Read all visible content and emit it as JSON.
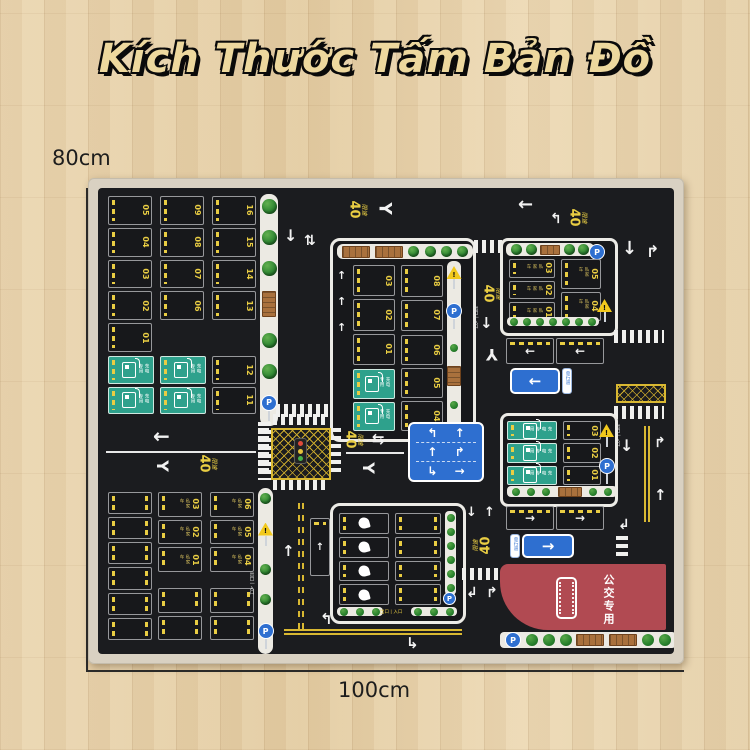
{
  "title": "Kích Thước Tấm Bản Đồ",
  "dimensions": {
    "height": "80cm",
    "width": "100cm"
  },
  "labels": {
    "speed_limit_prefix": "限速",
    "speed_limit_value": "40",
    "exit_entry": "出口 | 入口",
    "bus_only": "公交专用",
    "one_way": "单行道",
    "private_car": "私家车",
    "charging": "充电专用",
    "parking": "P"
  },
  "colors": {
    "mat_black": "#1b1c1f",
    "marking_yellow": "#e9cd43",
    "charging_green": "#2ea18c",
    "bus_red": "#b14a52",
    "sign_blue": "#2e6fd0",
    "wood": "#e9d6b2",
    "title_gold": "#edd89e"
  },
  "lots": {
    "tl": {
      "c1": [
        "05",
        "04",
        "03",
        "02",
        "01"
      ],
      "c2": [
        "09",
        "08",
        "07",
        "06"
      ],
      "c3": [
        "16",
        "15",
        "14",
        "13"
      ],
      "c4": [
        "12",
        "11"
      ],
      "g1": [
        "",
        ""
      ],
      "g2": [
        "",
        ""
      ]
    },
    "tc": {
      "l": [
        "03",
        "02",
        "01"
      ],
      "g": [
        "",
        ""
      ],
      "r1": [
        "08",
        "07"
      ],
      "r2": [
        "06",
        "05",
        "04"
      ]
    },
    "tr": {
      "l": [
        "03",
        "02",
        "01"
      ],
      "r": [
        "05",
        "04"
      ]
    },
    "mr": {
      "g": [
        "",
        "",
        ""
      ],
      "n": [
        "03",
        "02",
        "01"
      ]
    },
    "bl": {
      "p": [
        "",
        "",
        "",
        "",
        "",
        ""
      ],
      "m": [
        "03",
        "02",
        "01"
      ],
      "r": [
        "06",
        "05",
        "04"
      ],
      "low1": [
        "",
        ""
      ],
      "low2": [
        "",
        ""
      ]
    },
    "bc": {
      "duck": [
        "",
        "",
        "",
        ""
      ],
      "plain": [
        "",
        "",
        "",
        ""
      ]
    }
  }
}
